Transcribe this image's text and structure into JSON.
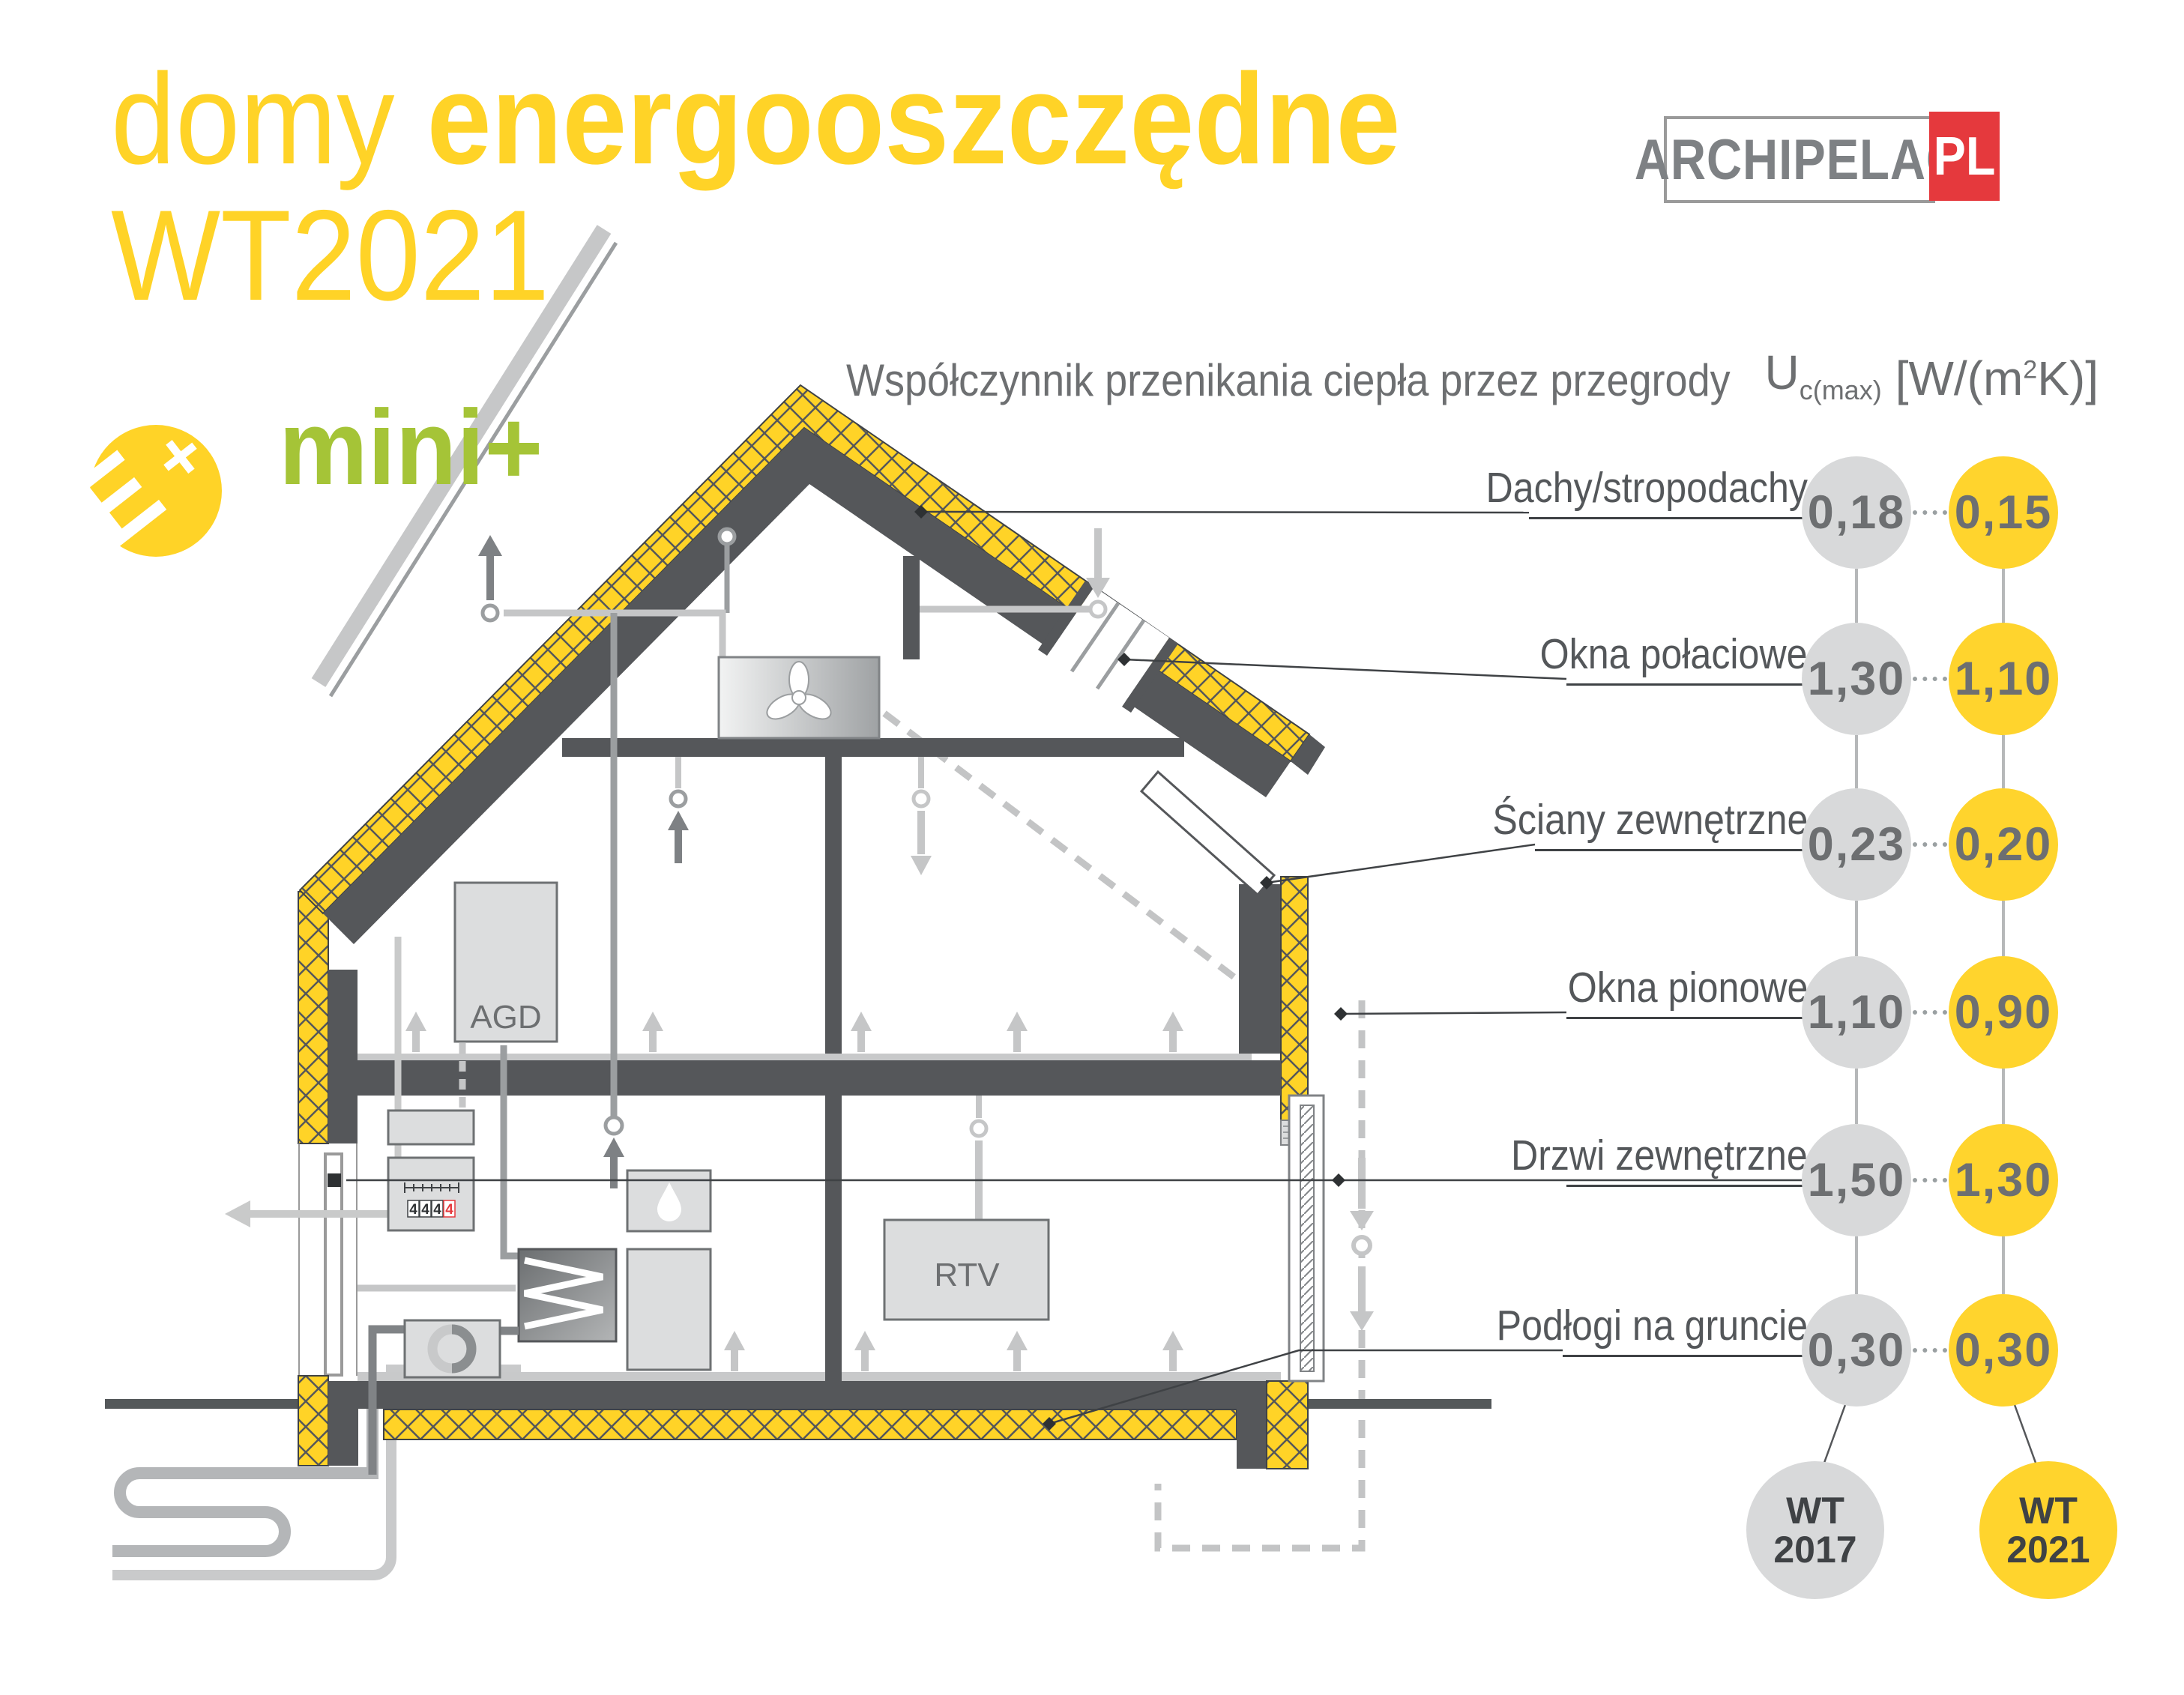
{
  "title": {
    "light": "domy ",
    "bold": "energooszczędne",
    "line2": "WT2021"
  },
  "logo": {
    "name": "ARCHIPELAG",
    "tld": "PL"
  },
  "badge": {
    "e": "E",
    "plus": "+",
    "mini": "mini+"
  },
  "header": {
    "text": "Współczynnik przenikania ciepła przez przegrody",
    "u": "U",
    "u_sub": "c(max)",
    "unit_pre": "[W/(m",
    "unit_sup": "2",
    "unit_post": "K)]"
  },
  "house": {
    "agd": "AGD",
    "rtv": "RTV",
    "meter_digits": [
      "4",
      "4",
      "4",
      "4"
    ]
  },
  "table": {
    "rows": [
      {
        "label": "Dachy/stropodachy",
        "wt2017": "0,18",
        "wt2021": "0,15"
      },
      {
        "label": "Okna połaciowe",
        "wt2017": "1,30",
        "wt2021": "1,10"
      },
      {
        "label": "Ściany zewnętrzne",
        "wt2017": "0,23",
        "wt2021": "0,20"
      },
      {
        "label": "Okna pionowe",
        "wt2017": "1,10",
        "wt2021": "0,90"
      },
      {
        "label": "Drzwi zewnętrzne",
        "wt2017": "1,50",
        "wt2021": "1,30"
      },
      {
        "label": "Podłogi na gruncie",
        "wt2017": "0,30",
        "wt2021": "0,30"
      }
    ],
    "wt2017": {
      "line1": "WT",
      "line2": "2017"
    },
    "wt2021": {
      "line1": "WT",
      "line2": "2021"
    }
  },
  "colors": {
    "accent_yellow": "#FFD327",
    "circle_gray": "#D8D9DA",
    "circle_yellow": "#FFD42D",
    "structure_dark": "#55575A",
    "green": "#A5C437",
    "red": "#E5393D",
    "text_gray": "#6d6f71"
  }
}
